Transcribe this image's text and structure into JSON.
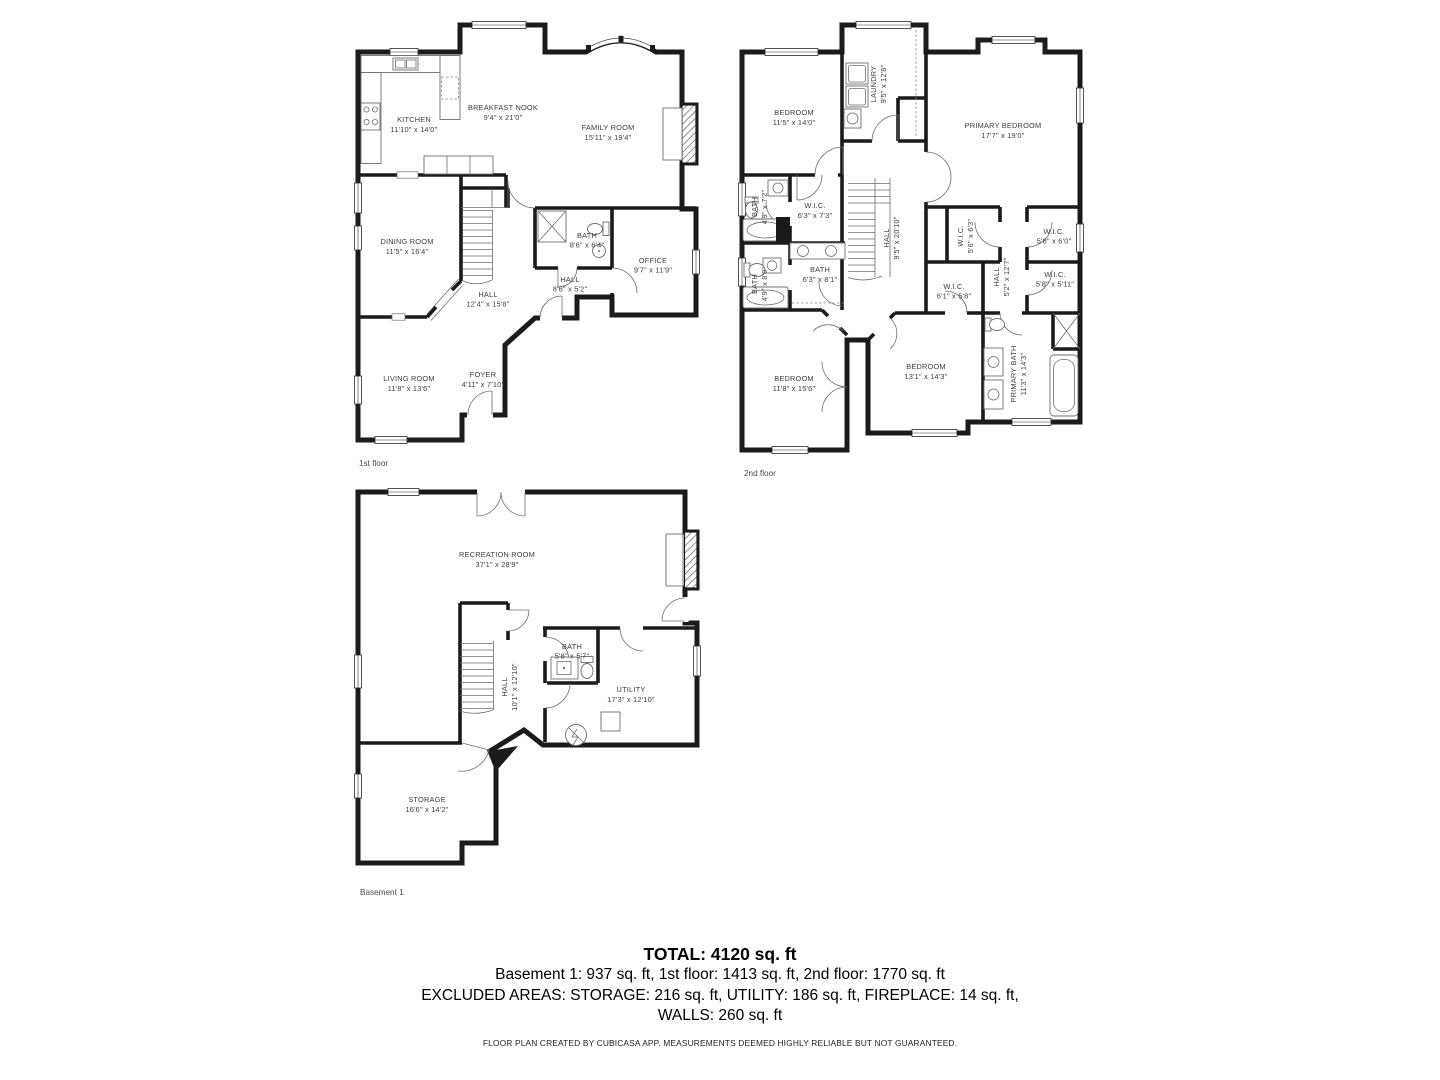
{
  "floors": [
    {
      "label": "1st floor",
      "rooms": [
        {
          "id": "kitchen",
          "name": "KITCHEN",
          "dims": "11'10\" x 14'0\""
        },
        {
          "id": "breakfast-nook",
          "name": "BREAKFAST NOOK",
          "dims": "9'4\" x 21'0\""
        },
        {
          "id": "family-room",
          "name": "FAMILY ROOM",
          "dims": "15'11\" x 19'4\""
        },
        {
          "id": "dining-room",
          "name": "DINING ROOM",
          "dims": "11'5\" x 16'4\""
        },
        {
          "id": "bath",
          "name": "BATH",
          "dims": "8'6\" x 6'4\""
        },
        {
          "id": "office",
          "name": "OFFICE",
          "dims": "9'7\" x 11'9\""
        },
        {
          "id": "hall-small",
          "name": "HALL",
          "dims": "8'6\" x 5'2\""
        },
        {
          "id": "hall",
          "name": "HALL",
          "dims": "12'4\" x 15'8\""
        },
        {
          "id": "living-room",
          "name": "LIVING ROOM",
          "dims": "11'8\" x 13'6\""
        },
        {
          "id": "foyer",
          "name": "FOYER",
          "dims": "4'11\" x 7'10\""
        }
      ]
    },
    {
      "label": "2nd floor",
      "rooms": [
        {
          "id": "bedroom-1",
          "name": "BEDROOM",
          "dims": "11'5\" x 14'0\""
        },
        {
          "id": "laundry",
          "name": "LAUNDRY",
          "dims": "9'5\" x 12'8\""
        },
        {
          "id": "primary-bedroom",
          "name": "PRIMARY BEDROOM",
          "dims": "17'7\" x 19'0\""
        },
        {
          "id": "bath-1",
          "name": "BATH",
          "dims": "4'9\" x 7'2\""
        },
        {
          "id": "wic-1",
          "name": "W.I.C.",
          "dims": "6'3\" x 7'3\""
        },
        {
          "id": "hall-center",
          "name": "HALL",
          "dims": "9'5\" x 20'10\""
        },
        {
          "id": "wic-2",
          "name": "W.I.C.",
          "dims": "5'6\" x 6'3\""
        },
        {
          "id": "wic-3",
          "name": "W.I.C.",
          "dims": "5'8\" x 6'0\""
        },
        {
          "id": "bath-2",
          "name": "BATH",
          "dims": "6'3\" x 8'1\""
        },
        {
          "id": "bath-3",
          "name": "BATH",
          "dims": "4'9\" x 8'0\""
        },
        {
          "id": "wic-4",
          "name": "W.I.C.",
          "dims": "6'1\" x 5'8\""
        },
        {
          "id": "hall-right",
          "name": "HALL",
          "dims": "5'2\" x 12'7\""
        },
        {
          "id": "wic-5",
          "name": "W.I.C.",
          "dims": "5'8\" x 5'11\""
        },
        {
          "id": "bedroom-2",
          "name": "BEDROOM",
          "dims": "11'8\" x 15'6\""
        },
        {
          "id": "bedroom-3",
          "name": "BEDROOM",
          "dims": "13'1\" x 14'3\""
        },
        {
          "id": "primary-bath",
          "name": "PRIMARY BATH",
          "dims": "11'3\" x 14'3\""
        }
      ]
    },
    {
      "label": "Basement 1",
      "rooms": [
        {
          "id": "recreation-room",
          "name": "RECREATION ROOM",
          "dims": "37'1\" x 28'9\""
        },
        {
          "id": "bath",
          "name": "BATH",
          "dims": "5'8\" x 5'7\""
        },
        {
          "id": "hall",
          "name": "HALL",
          "dims": "10'1\" x 12'10\""
        },
        {
          "id": "utility",
          "name": "UTILITY",
          "dims": "17'3\" x 12'10\""
        },
        {
          "id": "storage",
          "name": "STORAGE",
          "dims": "16'6\" x 14'2\""
        }
      ]
    }
  ],
  "summary": {
    "total": "TOTAL: 4120 sq. ft",
    "floor_breakdown": "Basement 1: 937 sq. ft, 1st floor: 1413 sq. ft, 2nd floor: 1770 sq. ft",
    "excluded_line1": "EXCLUDED AREAS: STORAGE: 216 sq. ft, UTILITY: 186 sq. ft, FIREPLACE: 14 sq. ft,",
    "excluded_line2": "WALLS: 260 sq. ft",
    "disclaimer": "FLOOR PLAN CREATED BY CUBICASA APP. MEASUREMENTS DEEMED HIGHLY RELIABLE BUT NOT GUARANTEED."
  },
  "colors": {
    "wall": "#1b1b1b",
    "label_text": "#3d3d3d",
    "background": "#ffffff"
  }
}
